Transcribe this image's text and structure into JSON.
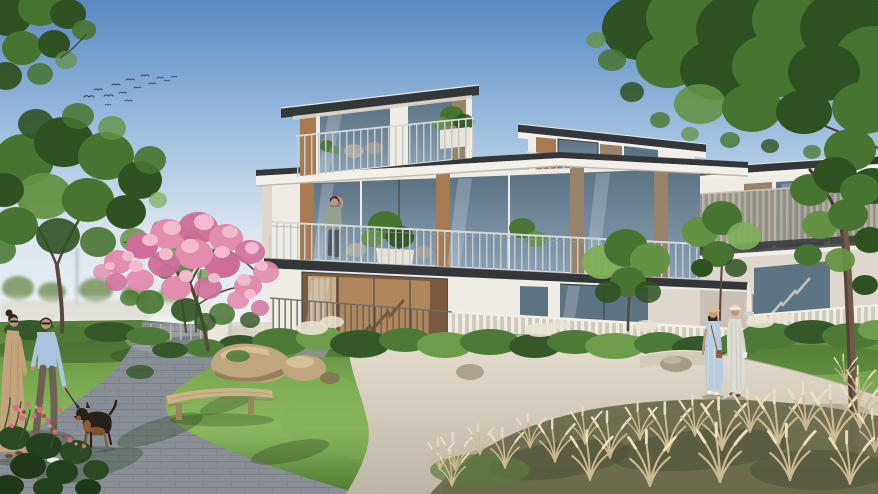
{
  "scene": {
    "description": "Sunlit architectural rendering of a modern three-storey villa community: white flat-roofed houses with wood accents and glass balconies, landscaped gardens with a pink flowering tree, rocks, a curved wooden bench, ornamental grasses, curved walkways, a couple walking a small dog on the left, two women strolling on the right, a man on a balcony, and a flock of birds in a clear blue sky.",
    "visible_text": []
  },
  "counts": {
    "birds": 14,
    "people": 5,
    "dogs": 1,
    "buildings": 3,
    "benches": 1
  },
  "palette": {
    "sky-top": "#5988c3",
    "sky-mid": "#9dbede",
    "sky-low": "#d9e5ef",
    "sky-horizon": "#edf2f4",
    "roof": "#34373a",
    "fascia": "#f3f0e9",
    "wall": "#efece5",
    "wall-shade": "#ddd7cd",
    "wall-shadow": "#c6bfb2",
    "wood": "#a87a4f",
    "wood-dark": "#8a6038",
    "wood-mute": "#99826a",
    "glass": "#87a0b2",
    "glass-dark": "#5c7384",
    "glass-light": "#b7cbd6",
    "frame": "#3e4449",
    "interior": "#b68c60",
    "interior-dark": "#7a593c",
    "curtain": "#cdb493",
    "lawn-dark": "#557f38",
    "lawn": "#74a44c",
    "lawn-light": "#8cba60",
    "bush": "#4d7b37",
    "bush-dark": "#355829",
    "bush-light": "#6d9c4a",
    "tree": "#477430",
    "tree-dark": "#2f5222",
    "tree-light": "#649245",
    "tree-bright": "#7fae55",
    "pink": "#e28cae",
    "pink-dark": "#ce6e98",
    "pink-light": "#f3b9cd",
    "trunk": "#5a4636",
    "paver": "#8a8f96",
    "concrete": "#dcd5c5",
    "concrete-shade": "#bcb4a4",
    "plume": "#cbb992",
    "plume-light": "#ecdfbd",
    "rock": "#c0a67f",
    "rock-dark": "#847050",
    "rock-light": "#dcc79f",
    "rock-gray": "#a59c89",
    "bench": "#c9b38a",
    "bench-dark": "#9d8560",
    "skin": "#c89478",
    "hair": "#32271f",
    "shirt-blue": "#a9c4dc",
    "pants": "#6e6154",
    "dress-tan": "#c2a37c",
    "dress-blue": "#b7cddd",
    "dress-white": "#dddcd5",
    "hat-straw": "#d8bf8c",
    "dog-dark": "#29221a",
    "dog-tan": "#8c5c35",
    "bird": "#36475b",
    "shadow-green": "#243d1f",
    "path-shadow": "#8e8574",
    "distant": "#d9d5cb",
    "distant-green": "#87a173"
  }
}
